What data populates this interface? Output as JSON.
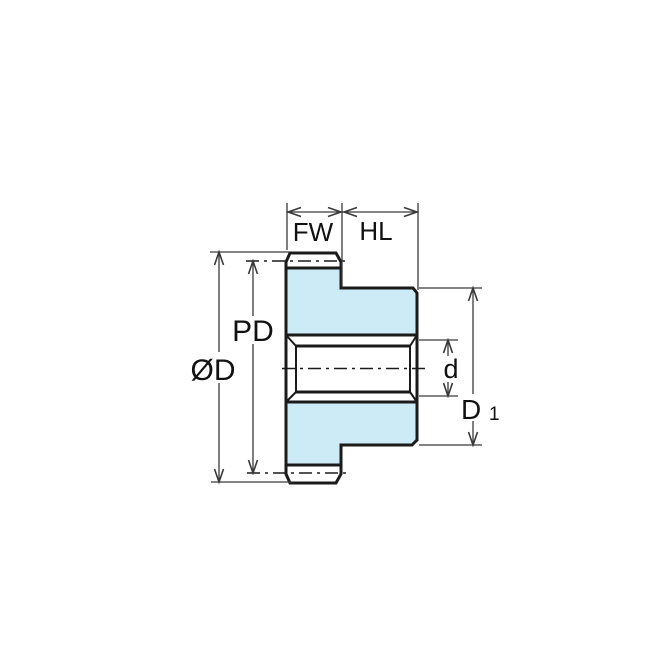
{
  "diagram": {
    "kind": "spur-gear-cross-section-dimension-drawing",
    "labels": {
      "face_width": "FW",
      "hub_length": "HL",
      "pitch_diameter": "PD",
      "outside_diameter": "ØD",
      "bore_diameter": "d",
      "hub_diameter_main": "D",
      "hub_diameter_sub": "1"
    },
    "colors": {
      "part_fill": "#cdeaf7",
      "part_outline": "#1b1b1b",
      "dimension_line": "#3a3a3a",
      "label_text": "#111111",
      "background": "#ffffff"
    }
  }
}
